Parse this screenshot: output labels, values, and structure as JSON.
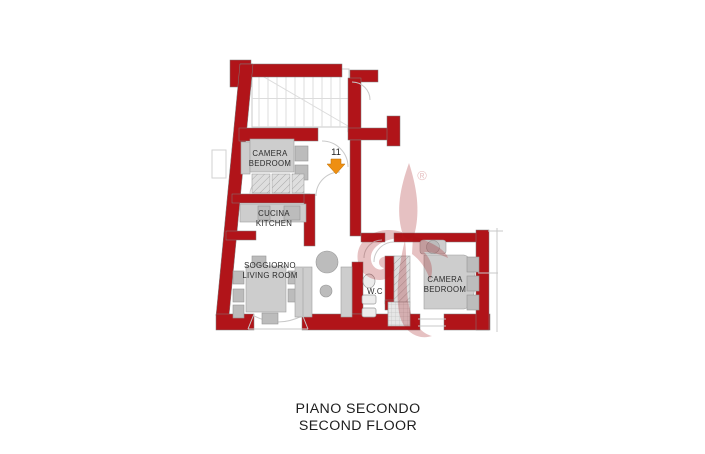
{
  "floor_plan": {
    "title_line1": "PIANO SECONDO",
    "title_line2": "SECOND FLOOR",
    "entrance": {
      "unit_number": "11"
    },
    "watermark": {
      "registered_mark": "®"
    },
    "rooms": [
      {
        "id": "bedroom-left",
        "label_line1": "CAMERA",
        "label_line2": "BEDROOM"
      },
      {
        "id": "kitchen",
        "label_line1": "CUCINA",
        "label_line2": "KITCHEN"
      },
      {
        "id": "living-room",
        "label_line1": "SOGGIORNO",
        "label_line2": "LIVING ROOM"
      },
      {
        "id": "wc",
        "label_line1": "W.C",
        "label_line2": ""
      },
      {
        "id": "bedroom-right",
        "label_line1": "CAMERA",
        "label_line2": "BEDROOM"
      }
    ],
    "colors": {
      "wall": "#b11419",
      "furniture": "#cdcdcd",
      "furniture_dark": "#bcbcbc",
      "stair_lines": "#dcdcdc",
      "entrance_arrow": "#ee8f12",
      "watermark": "#a31318",
      "text": "#2b2b2b"
    }
  }
}
